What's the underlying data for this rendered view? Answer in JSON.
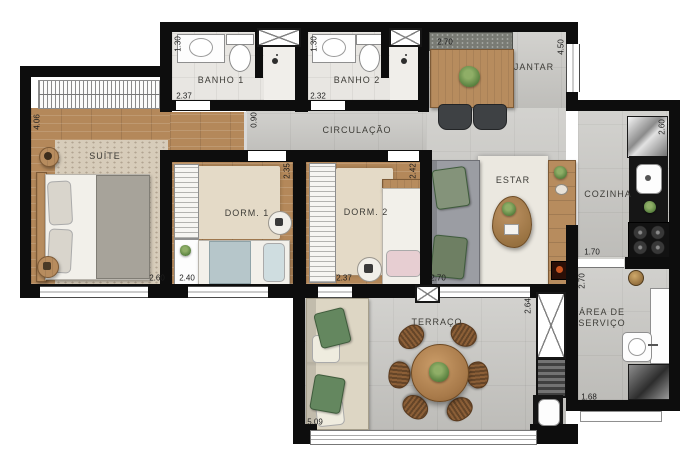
{
  "plan_title": "apartment-floor-plan",
  "rooms": {
    "suite": {
      "label": "SUÍTE"
    },
    "banho1": {
      "label": "BANHO 1"
    },
    "banho2": {
      "label": "BANHO 2"
    },
    "jantar": {
      "label": "JANTAR"
    },
    "circulacao": {
      "label": "CIRCULAÇÃO"
    },
    "dorm1": {
      "label": "DORM. 1"
    },
    "dorm2": {
      "label": "DORM. 2"
    },
    "estar": {
      "label": "ESTAR"
    },
    "cozinha": {
      "label": "COZINHA"
    },
    "area_servico": {
      "line1": "ÁREA DE",
      "line2": "SERVIÇO"
    },
    "terraco": {
      "label": "TERRAÇO"
    }
  },
  "dims": {
    "suite_h": "4.06",
    "suite_w": "2.60",
    "banho1_h": "1.30",
    "banho1_w": "2.37",
    "banho2_h": "1.30",
    "banho2_w": "2.32",
    "jantar_w": "2.70",
    "jantar_h": "4.50",
    "circ_h": "0.90",
    "dorm1_h": "2.35",
    "dorm1_w": "2.40",
    "dorm2_h": "2.42",
    "dorm2_w": "2.37",
    "estar_w": "2.70",
    "cozinha_h": "2.60",
    "cozinha_opening": "1.70",
    "servico_h": "2.70",
    "servico_w": "1.68",
    "terraco_h": "2.64",
    "terraco_w": "5.09"
  },
  "colors": {
    "wall": "#0d0d0d",
    "wood": "#b4885a",
    "tile": "#c9c8c4",
    "carpet": "#d7ccba",
    "plant_green": "#537c3b",
    "counter_dark": "#161616"
  }
}
